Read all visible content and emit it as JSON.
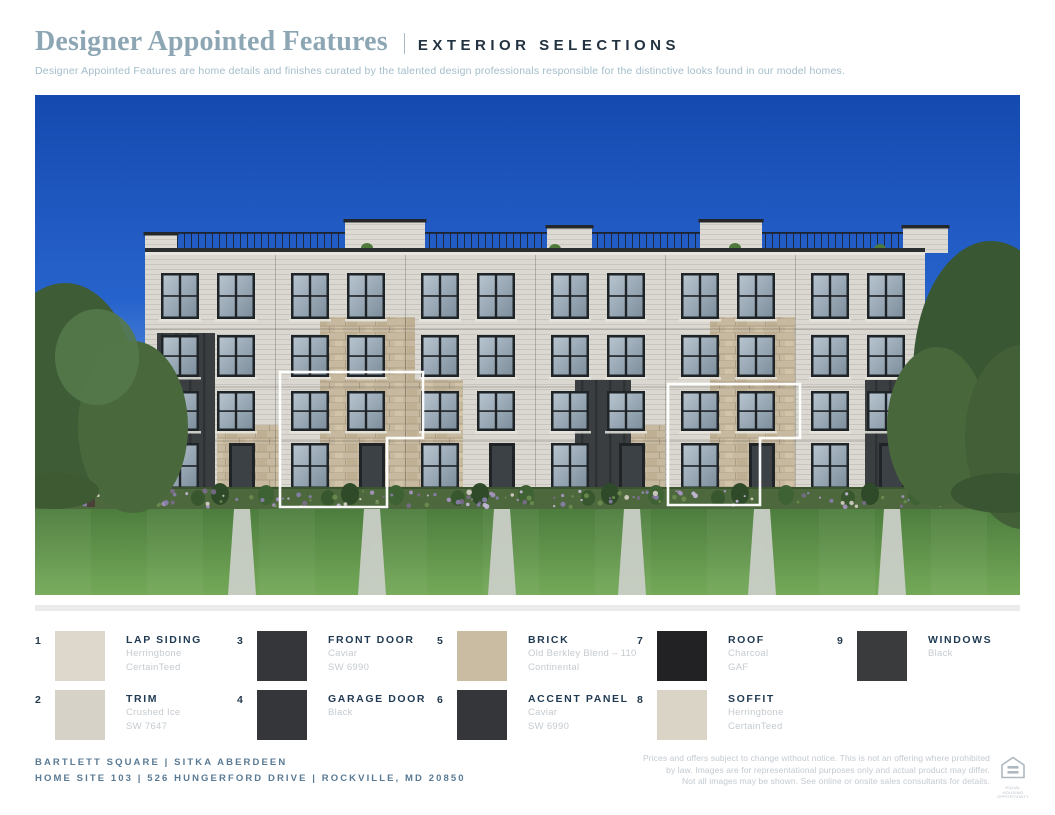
{
  "header": {
    "title": "Designer Appointed Features",
    "section_label": "EXTERIOR SELECTIONS",
    "description": "Designer Appointed Features are home details and finishes curated by the talented design professionals responsible for the distinctive looks found in our model homes."
  },
  "colors": {
    "title": "#8DA6B4",
    "section_label": "#233240",
    "legend_name": "#1F3A52",
    "footer_text": "#597A94",
    "sky_top": "#144AB0",
    "lawn": "#5C8F45",
    "divider": "#E9ECE8"
  },
  "legend": {
    "items": [
      {
        "number": "1",
        "name": "LAP SIDING",
        "detail1": "Herringbone",
        "detail2": "CertainTeed",
        "swatch": "#DDD8CB",
        "texture": "flat"
      },
      {
        "number": "2",
        "name": "TRIM",
        "detail1": "Crushed Ice",
        "detail2": "SW 7647",
        "swatch": "#D6D2C7",
        "texture": "flat"
      },
      {
        "number": "3",
        "name": "FRONT DOOR",
        "detail1": "Caviar",
        "detail2": "SW 6990",
        "swatch": "#343639",
        "texture": "flat"
      },
      {
        "number": "4",
        "name": "GARAGE DOOR",
        "detail1": "Black",
        "detail2": "",
        "swatch": "#343639",
        "texture": "flat"
      },
      {
        "number": "5",
        "name": "BRICK",
        "detail1": "Old Berkley Blend – 110",
        "detail2": "Continental",
        "swatch": "#C9BCA3",
        "texture": "brick"
      },
      {
        "number": "6",
        "name": "ACCENT PANEL",
        "detail1": "Caviar",
        "detail2": "SW 6990",
        "swatch": "#343639",
        "texture": "flat"
      },
      {
        "number": "7",
        "name": "ROOF",
        "detail1": "Charcoal",
        "detail2": "GAF",
        "swatch": "#222224",
        "texture": "shingle"
      },
      {
        "number": "8",
        "name": "SOFFIT",
        "detail1": "Herringbone",
        "detail2": "CertainTeed",
        "swatch": "#D9D4C6",
        "texture": "flat"
      },
      {
        "number": "9",
        "name": "WINDOWS",
        "detail1": "Black",
        "detail2": "",
        "swatch": "#3A3B3D",
        "texture": "flat"
      }
    ]
  },
  "footer": {
    "line1": "BARTLETT SQUARE  |  SITKA ABERDEEN",
    "line2": "HOME SITE 103  |  526 HUNGERFORD DRIVE  |  ROCKVILLE, MD 20850",
    "disclaimer1": "Prices and offers subject to change without notice. This is not an offering where prohibited",
    "disclaimer2": "by law. Images are for representational purposes only and actual product may differ.",
    "disclaimer3": "Not all images may be shown. See online or onsite sales consultants for details.",
    "equal_housing_label": "EQUAL HOUSING OPPORTUNITY"
  }
}
